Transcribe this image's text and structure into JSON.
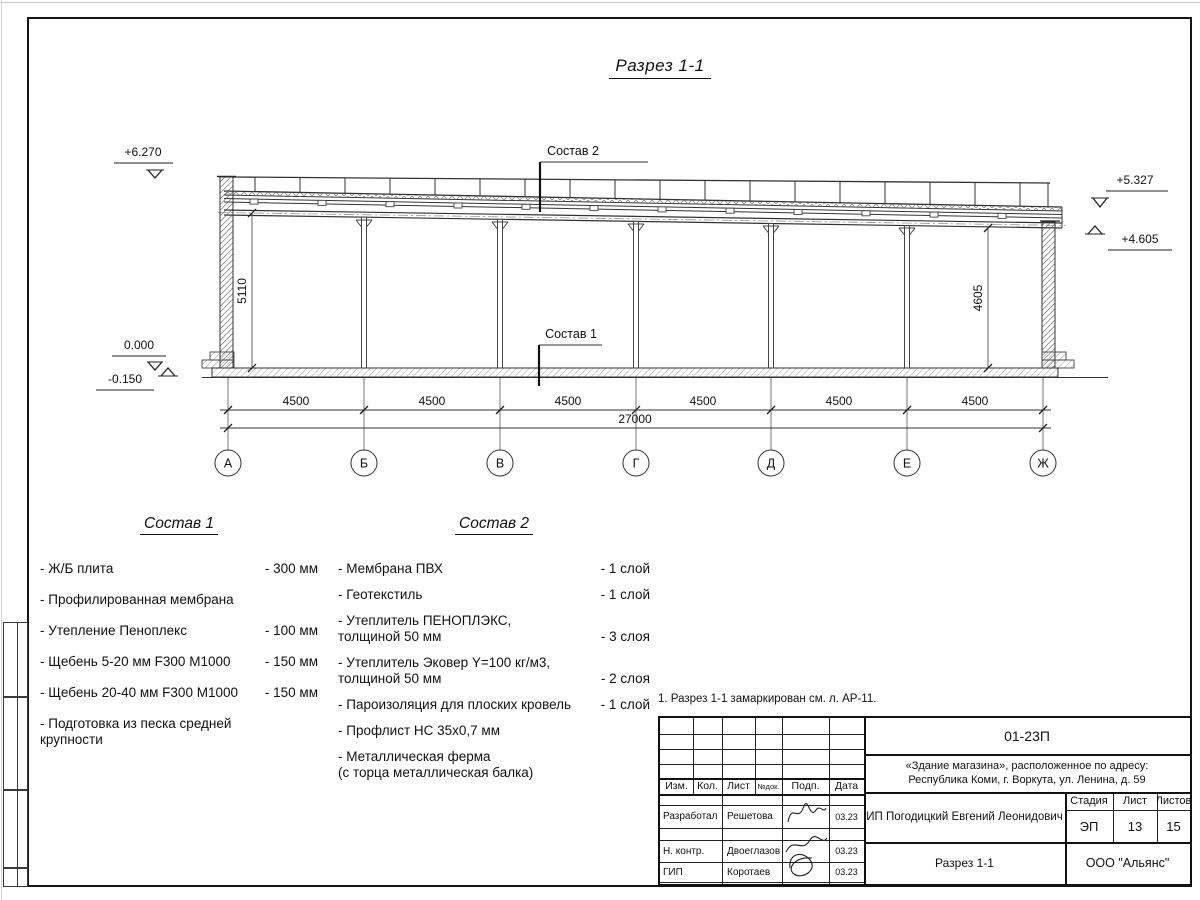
{
  "drawing": {
    "section_title": "Разрез 1-1",
    "labels": {
      "sostav1": "Состав 1",
      "sostav2": "Состав 2"
    },
    "elevations": {
      "roof_left": "+6.270",
      "roof_right": "+5.327",
      "truss_right": "+4.605",
      "floor": "0.000",
      "ground": "-0.150"
    },
    "dims": {
      "left_height": "5110",
      "right_height": "4605",
      "bay": "4500",
      "total": "27000"
    },
    "axes": [
      "А",
      "Б",
      "В",
      "Г",
      "Д",
      "Е",
      "Ж"
    ]
  },
  "comp1": {
    "title": "Состав 1",
    "items": [
      {
        "name": "- Ж/Б плита",
        "value": "- 300 мм"
      },
      {
        "name": "- Профилированная мембрана",
        "value": ""
      },
      {
        "name": "- Утепление Пеноплекс",
        "value": "- 100 мм"
      },
      {
        "name": "-  Щебень 5-20 мм F300 М1000",
        "value": "- 150 мм"
      },
      {
        "name": "-  Щебень 20-40 мм F300 М1000",
        "value": "- 150 мм"
      },
      {
        "name": "- Подготовка из песка средней\n  крупности",
        "value": ""
      }
    ]
  },
  "comp2": {
    "title": "Состав 2",
    "items": [
      {
        "name": "- Мембрана ПВХ",
        "value": "- 1 слой"
      },
      {
        "name": "- Геотекстиль",
        "value": "- 1 слой"
      },
      {
        "name": "- Утеплитель ПЕНОПЛЭКС,\n  толщиной 50 мм",
        "value": "- 3 слоя"
      },
      {
        "name": "- Утеплитель Эковер Y=100 кг/м3,\n  толщиной 50 мм",
        "value": "- 2 слоя"
      },
      {
        "name": "- Пароизоляция для плоских кровель",
        "value": "- 1 слой"
      },
      {
        "name": "- Профлист НС 35х0,7 мм",
        "value": ""
      },
      {
        "name": "- Металлическая ферма\n  (с торца металлическая балка)",
        "value": ""
      }
    ]
  },
  "note": "1. Разрез 1-1 замаркирован см. л. АР-11.",
  "titleblock": {
    "doc_number": "01-23П",
    "object_line1": "«Здание магазина», расположенное по адресу:",
    "object_line2": "Республика Коми, г. Воркута, ул. Ленина, д. 59",
    "header": {
      "izm": "Изм.",
      "kol": "Кол.",
      "list": "Лист",
      "ndok": "№док.",
      "podp": "Подп.",
      "data": "Дата"
    },
    "rows": [
      {
        "role": "Разработал",
        "name": "Решетова",
        "date": "03.23"
      },
      {
        "role": "Н. контр.",
        "name": "Двоеглазов",
        "date": "03.23"
      },
      {
        "role": "ГИП",
        "name": "Коротаев",
        "date": "03.23"
      }
    ],
    "client": "ИП Погодицкий Евгений Леонидович",
    "stage_label": "Стадия",
    "sheet_label": "Лист",
    "sheets_label": "Листов",
    "stage": "ЭП",
    "sheet": "13",
    "sheets": "15",
    "sheet_title": "Разрез 1-1",
    "company": "ООО \"Альянс\""
  }
}
